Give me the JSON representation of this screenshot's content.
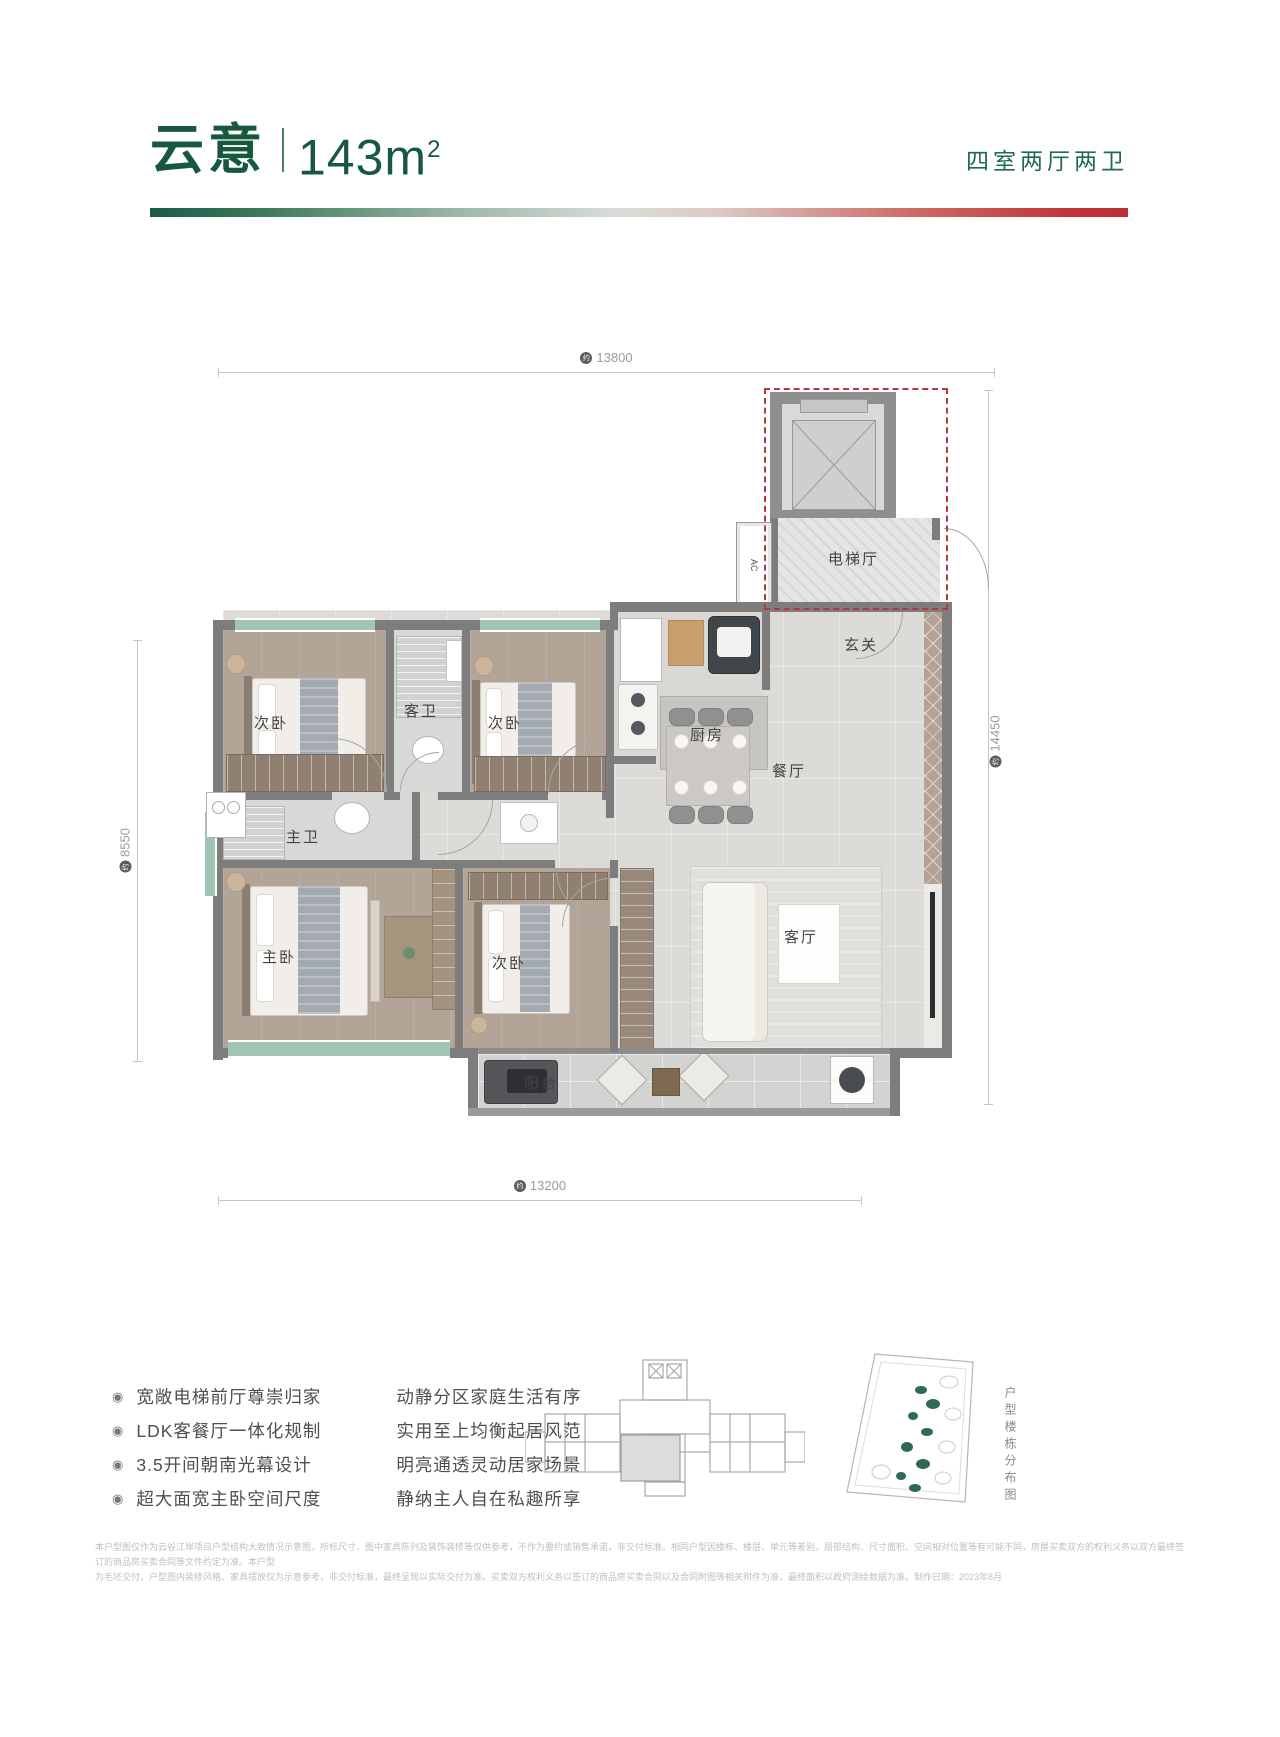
{
  "header": {
    "name": "云意",
    "area_value": "143m",
    "area_sup": "2",
    "spec": "四室两厅两卫"
  },
  "floorplan": {
    "dims": {
      "prefix": "约",
      "top": "13800",
      "right": "14450",
      "left": "8550",
      "bottom": "13200"
    },
    "rooms": {
      "elevator_hall": "电梯厅",
      "entry": "玄关",
      "kitchen": "厨房",
      "dining": "餐厅",
      "living": "客厅",
      "balcony": "阳台",
      "master_bedroom": "主卧",
      "master_bath": "主卫",
      "guest_bath": "客卫",
      "bedroom_a": "次卧",
      "bedroom_b": "次卧",
      "bedroom_c": "次卧",
      "ac_closet": "AC"
    }
  },
  "features": {
    "bullet": "◉",
    "items": [
      {
        "left": "宽敞电梯前厅尊崇归家",
        "right": "动静分区家庭生活有序"
      },
      {
        "left": "LDK客餐厅一体化规制",
        "right": "实用至上均衡起居风范"
      },
      {
        "left": "3.5开间朝南光幕设计",
        "right": "明亮通透灵动居家场景"
      },
      {
        "left": "超大面宽主卧空间尺度",
        "right": "静纳主人自在私趣所享"
      }
    ]
  },
  "footer": {
    "map_caption": "户型楼栋分布图"
  },
  "disclaimer": {
    "line1": "本户型图仅作为云谷江岸项目户型结构大致情况示意图，所标尺寸、图中家具陈列及装饰装修等仅供参考，不作为要约或销售承诺，非交付标准。相同户型因楼栋、楼层、单元等差别，局部结构、尺寸面积、空间相对位置等有可能不同，房屋买卖双方的权利义务以双方最终签订的商品房买卖合同等文件约定为准。本户型",
    "line2": "为毛坯交付，户型图内装修风格、家具摆放仅为示意参考，非交付标准，最终呈现以实际交付为准。买卖双方权利义务以签订的商品房买卖合同以及合同附图等相关附件为准，最终面积以政府测绘数据为准。制作日期：2023年8月"
  }
}
